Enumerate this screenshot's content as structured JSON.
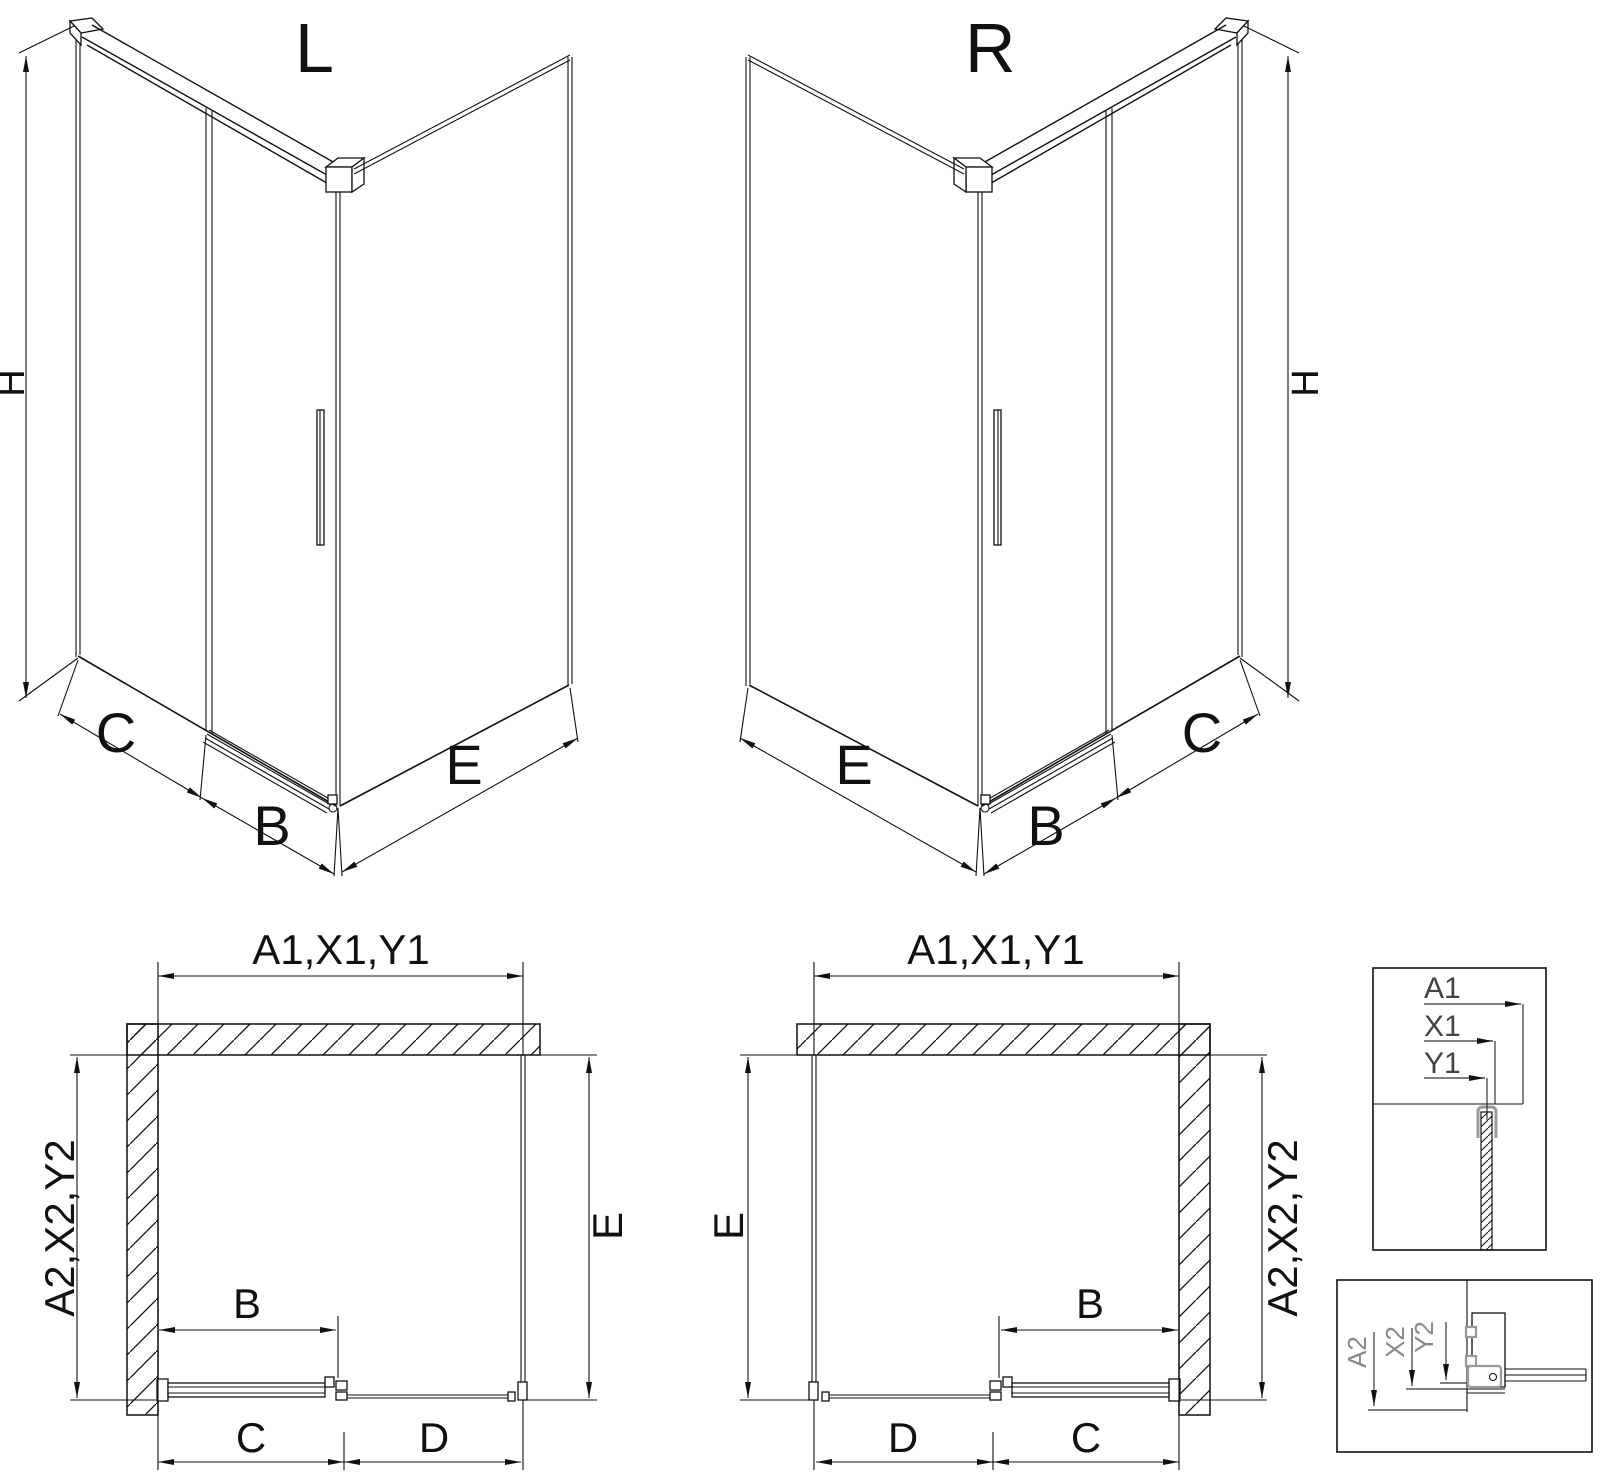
{
  "views": {
    "iso_left": {
      "title": "L",
      "dim_height": "H",
      "dim_fixed_panel": "C",
      "dim_door": "B",
      "dim_side_panel": "E"
    },
    "iso_right": {
      "title": "R",
      "dim_height": "H",
      "dim_side_panel": "E",
      "dim_door": "B",
      "dim_fixed_panel": "C"
    },
    "plan_left": {
      "dim_top": "A1,X1,Y1",
      "dim_left": "A2,X2,Y2",
      "dim_right": "E",
      "dim_door": "B",
      "dim_bottom_c": "C",
      "dim_bottom_d": "D"
    },
    "plan_right": {
      "dim_top": "A1,X1,Y1",
      "dim_right": "A2,X2,Y2",
      "dim_left": "E",
      "dim_door": "B",
      "dim_bottom_d": "D",
      "dim_bottom_c": "C"
    },
    "detail_top": {
      "dim_a": "A1",
      "dim_x": "X1",
      "dim_y": "Y1"
    },
    "detail_bottom": {
      "dim_a": "A2",
      "dim_x": "X2",
      "dim_y": "Y2"
    }
  },
  "colors": {
    "background": "#ffffff",
    "line": "#111111",
    "detail_label_top": "#444444",
    "detail_label_bottom": "#888888",
    "accent_gray": "#9a9a9a"
  }
}
